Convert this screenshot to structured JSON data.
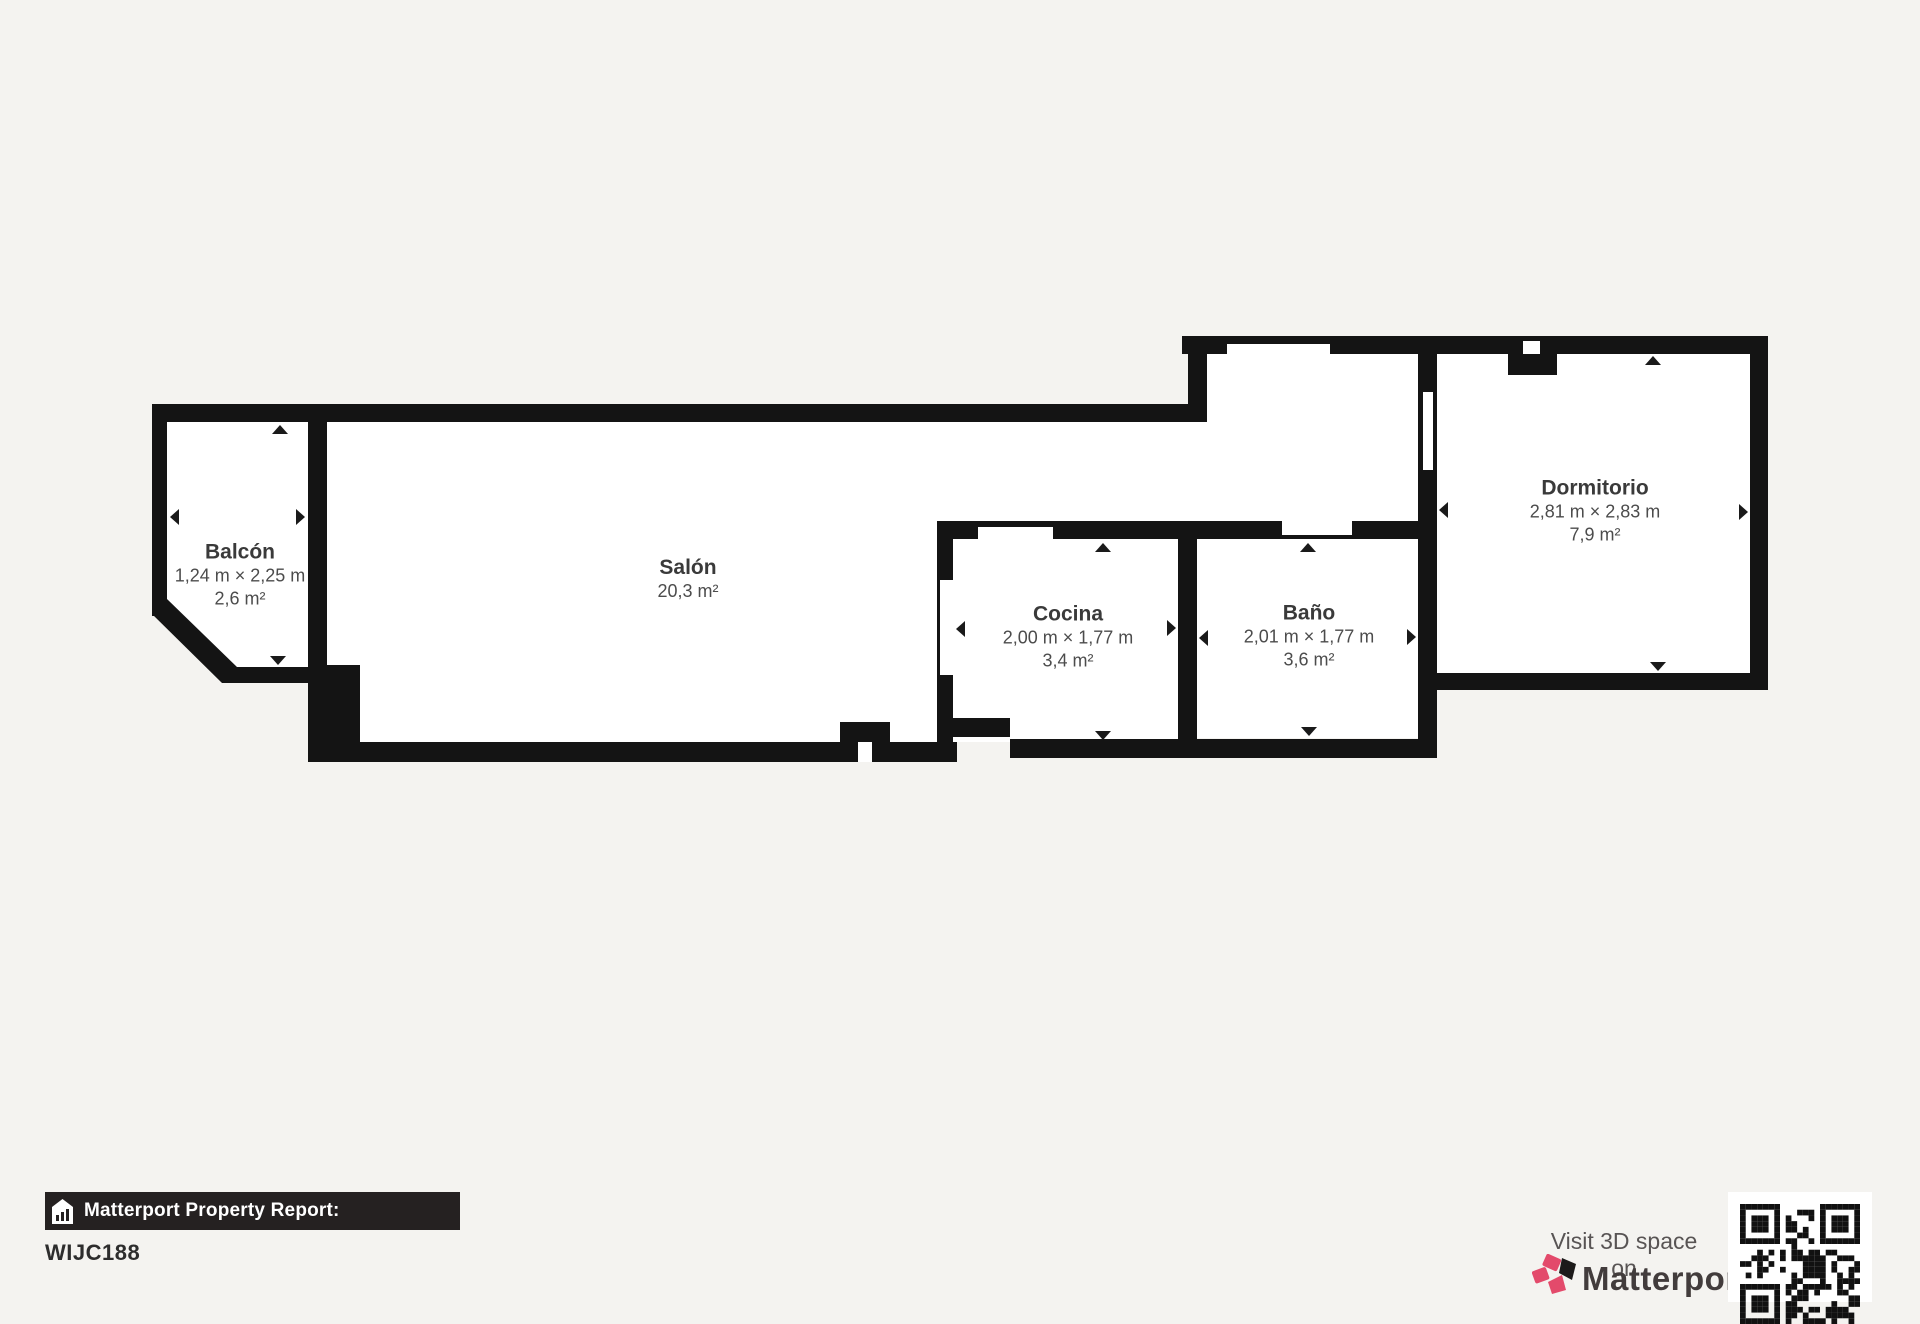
{
  "floorplan": {
    "rooms": [
      {
        "name": "Balcón",
        "dimensions": "1,24 m × 2,25 m",
        "area": "2,6 m²"
      },
      {
        "name": "Salón",
        "dimensions": "",
        "area": "20,3 m²"
      },
      {
        "name": "Cocina",
        "dimensions": "2,00 m × 1,77 m",
        "area": "3,4 m²"
      },
      {
        "name": "Baño",
        "dimensions": "2,01 m × 1,77 m",
        "area": "3,6 m²"
      },
      {
        "name": "Dormitorio",
        "dimensions": "2,81 m × 2,83 m",
        "area": "7,9 m²"
      }
    ]
  },
  "footer": {
    "report_label": "Matterport Property Report:",
    "property_id": "WIJC188"
  },
  "cta": {
    "visit_text": "Visit 3D space on",
    "brand": "Matterport"
  },
  "colors": {
    "background": "#f4f3f0",
    "wall": "#141414",
    "floor": "#ffffff",
    "accent_pink": "#e34a6b",
    "bar_background": "#252121"
  }
}
